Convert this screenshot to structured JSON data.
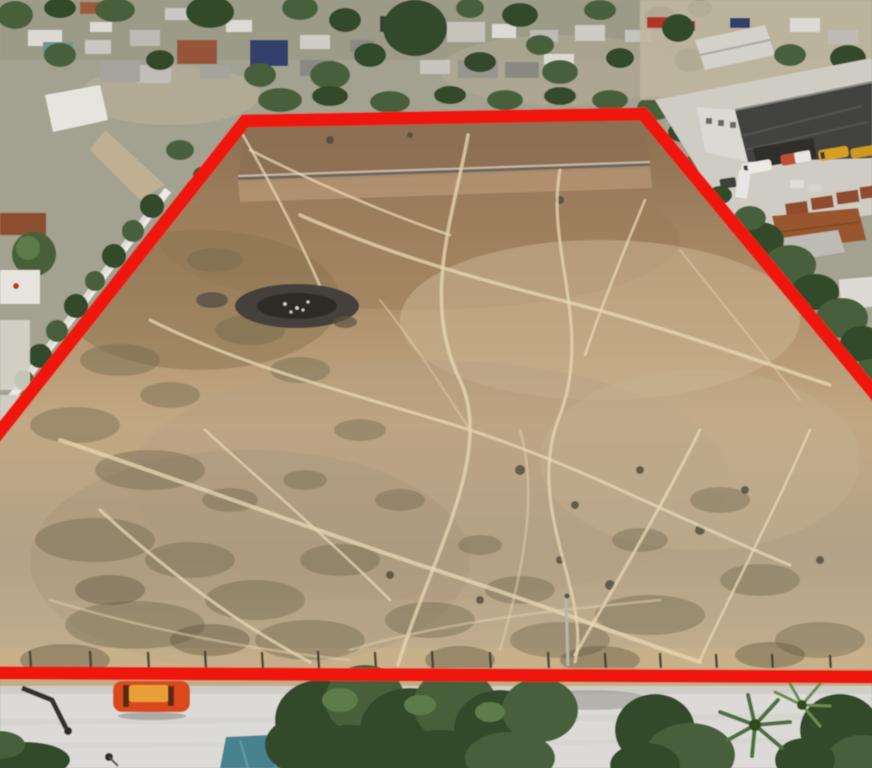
{
  "scene": {
    "description": "Aerial drone photograph of a large vacant dirt land parcel outlined with a thick red boundary polygon, bordered by a residential neighborhood to the north and west, a bus depot with a large warehouse to the east, and a dirt road with an orange parked car to the south"
  },
  "boundary": {
    "points": "-190,672 245,121 643,114 1110,678",
    "color": "#ee1511",
    "stroke_width": 13
  },
  "parcel": {
    "terrain_top_color": "#8a6e50",
    "terrain_mid_color": "#c0a47e",
    "terrain_low_color": "#b3a286",
    "trail_color": "#e8d8b4",
    "scrub_color": "#6e664d",
    "wall_color": "#6e655a",
    "rubble_color": "#45413a"
  },
  "north": {
    "base_color": "#a3a190"
  },
  "west": {
    "fence_color": "#eceae2"
  },
  "depot": {
    "apron_color": "#cfccc4",
    "roof_color": "#434340",
    "wall_color": "#dbd9d3",
    "parked_roofs_color": "#8f4c2d",
    "buses": [
      {
        "name": "white-bus",
        "color": "#eceae4"
      },
      {
        "name": "red-white-bus",
        "color": "#c05038"
      },
      {
        "name": "yellow-bus",
        "color": "#d8a020"
      },
      {
        "name": "yellow-bus-2",
        "color": "#cf9a1e"
      }
    ]
  },
  "south": {
    "road_color": "#dcdad6",
    "shoulder_color": "#c6ac82",
    "tarp_color": "#47828e",
    "car": {
      "body_color": "#d9481b",
      "roof_color": "#e89f38"
    }
  }
}
